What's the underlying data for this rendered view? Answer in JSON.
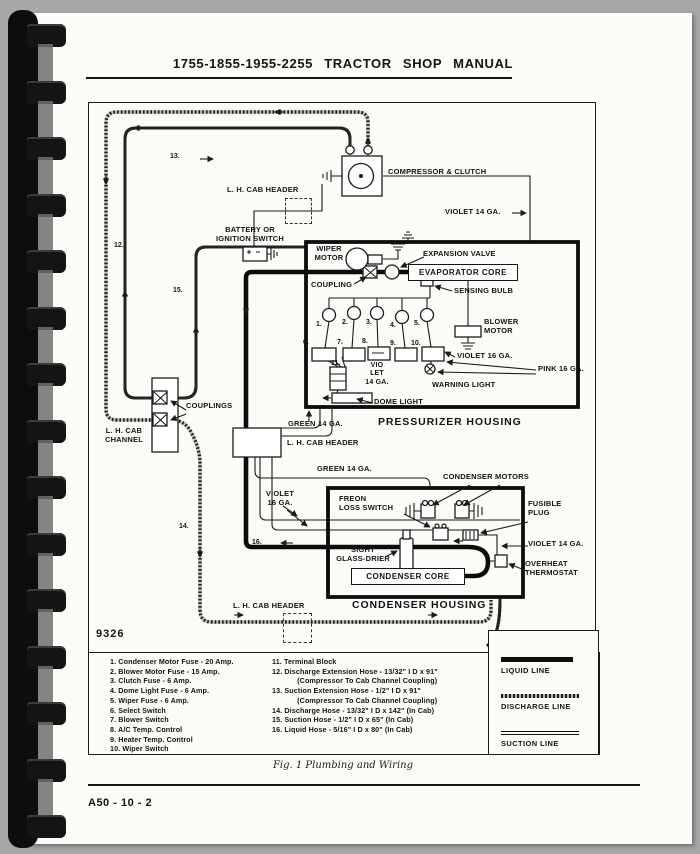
{
  "page": {
    "header_title": "1755-1855-1955-2255 TRACTOR SHOP MANUAL",
    "figure_number": "9326",
    "caption": "Fig. 1  Plumbing and Wiring",
    "footer_code": "A50 - 10 - 2"
  },
  "colors": {
    "page": "#fbfbf8",
    "ink": "#141414",
    "backdrop": "#a7a7a7"
  },
  "diagram": {
    "labels": {
      "lh_cab_header_top": "L. H. CAB HEADER",
      "battery": "BATTERY OR\nIGNITION SWITCH",
      "compressor": "COMPRESSOR & CLUTCH",
      "violet14_top": "VIOLET 14 GA.",
      "wiper_motor": "WIPER\nMOTOR",
      "expansion_valve": "EXPANSION VALVE",
      "evaporator_core": "EVAPORATOR CORE",
      "coupling": "COUPLING",
      "sensing_bulb": "SENSING BULB",
      "blower_motor": "BLOWER\nMOTOR",
      "violet16": "VIOLET 16 GA.",
      "pink16": "PINK 16 GA.",
      "warning_light": "WARNING LIGHT",
      "dome_light": "DOME LIGHT",
      "violet14_stacked": "VIO\nLET\n14 GA.",
      "pressurizer_housing": "PRESSURIZER HOUSING",
      "green14_upper": "GREEN 14 GA.",
      "lh_cab_header_mid": "L. H. CAB HEADER",
      "green14_lower": "GREEN 14 GA.",
      "couplings": "COUPLINGS",
      "lh_cab_channel": "L. H. CAB\nCHANNEL",
      "violet16_stacked": "VIOLET\n16 GA.",
      "freon_loss_switch": "FREON\nLOSS SWITCH",
      "condenser_motors": "CONDENSER MOTORS",
      "fusible_plug": "FUSIBLE\nPLUG",
      "violet14_condenser": "VIOLET 14 GA.",
      "sight_glass_drier": "SIGHT\nGLASS-DRIER",
      "condenser_core": "CONDENSER CORE",
      "overheat_thermostat": "OVERHEAT\nTHERMOSTAT",
      "condenser_housing": "CONDENSER HOUSING",
      "lh_cab_header_bottom": "L. H. CAB HEADER"
    },
    "wire_numbers": {
      "w12": "12.",
      "w13": "13.",
      "w14": "14.",
      "w15": "15.",
      "w16": "16."
    },
    "fuse_numbers": [
      "1.",
      "2.",
      "3.",
      "4.",
      "5."
    ],
    "component_numbers": [
      "6.",
      "7.",
      "8.",
      "9.",
      "10.",
      "11."
    ]
  },
  "legend": {
    "left_items": [
      "1. Condenser Motor Fuse - 20 Amp.",
      "2. Blower Motor Fuse - 15 Amp.",
      "3. Clutch Fuse - 6 Amp.",
      "4. Dome Light Fuse - 6 Amp.",
      "5. Wiper Fuse - 6 Amp.",
      "6. Select  Switch",
      "7. Blower Switch",
      "8. A/C Temp. Control",
      "9. Heater Temp. Control",
      "10. Wiper Switch"
    ],
    "right_items": [
      "11. Terminal Block",
      "12. Discharge Extension Hose - 13/32\" I D x 91\"\n            (Compressor To Cab Channel Coupling)",
      "13. Suction Extension Hose - 1/2\" I D x 91\"\n            (Compressor To Cab Channel Coupling)",
      "14. Discharge Hose - 13/32\" I D x 142\" (In Cab)",
      "15. Suction Hose - 1/2\" I D x 65\" (In Cab)",
      "16. Liquid Hose - 5/16\" I D x 80\" (In Cab)"
    ],
    "line_styles": [
      {
        "label": "LIQUID LINE"
      },
      {
        "label": "DISCHARGE LINE"
      },
      {
        "label": "SUCTION LINE"
      }
    ]
  }
}
